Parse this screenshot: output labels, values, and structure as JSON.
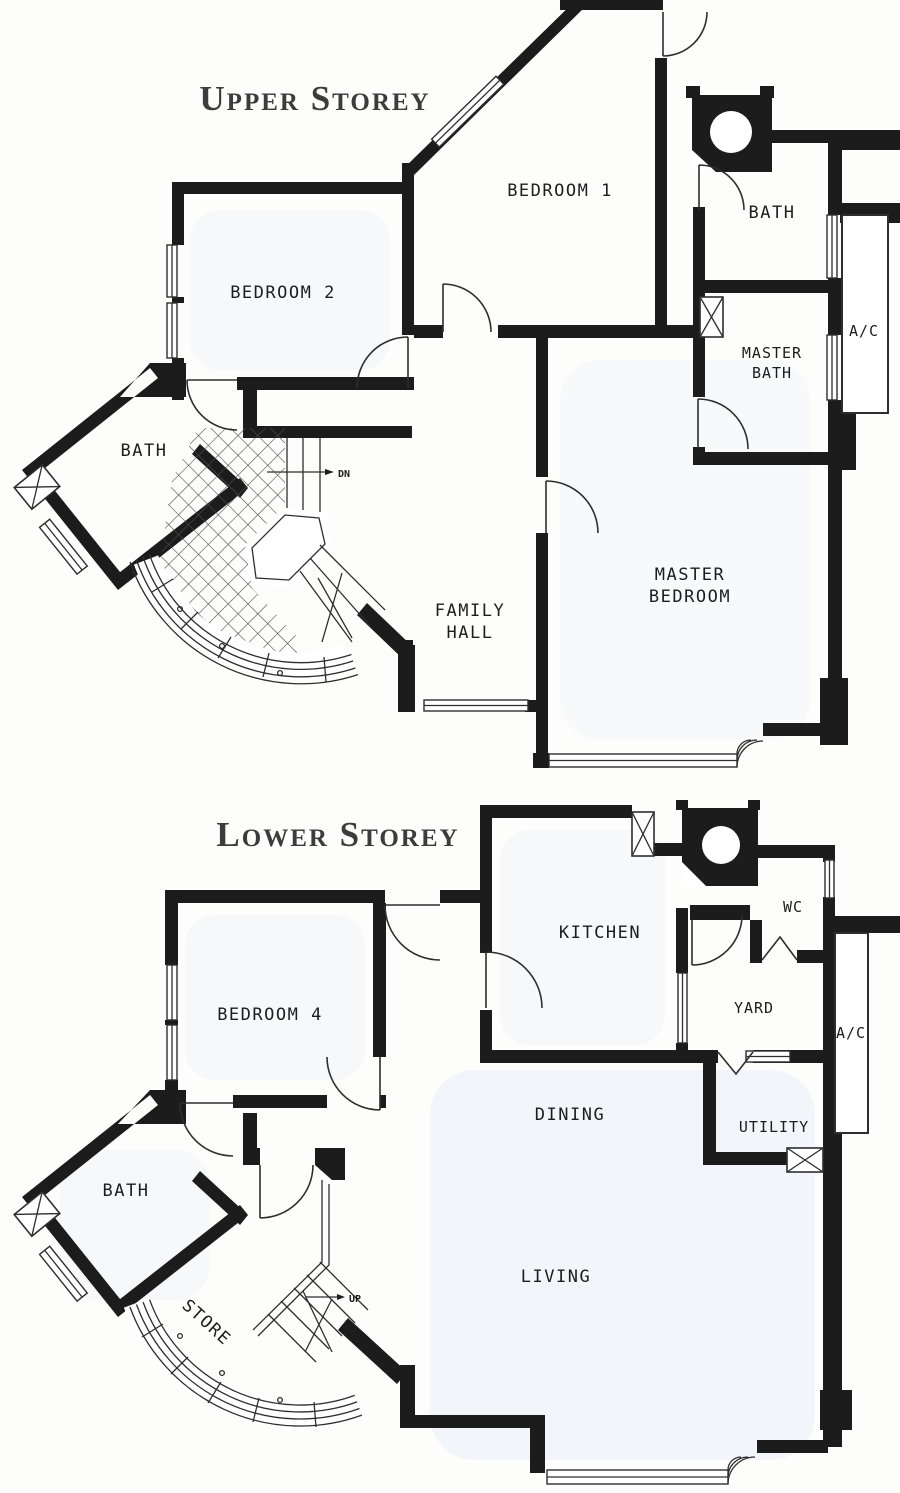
{
  "colors": {
    "wall": "#1c1c1c",
    "line": "#2e2e2e",
    "label": "#1d1d1d",
    "title": "#3c3c3c",
    "floor_tint": "#e8eef5",
    "paper": "#fdfdfc"
  },
  "upper": {
    "title": "Upper Storey",
    "labels": {
      "bedroom1": "BEDROOM 1",
      "bedroom2": "BEDROOM 2",
      "bath_right": "BATH",
      "bath_left": "BATH",
      "master_bath": [
        "MASTER",
        "BATH"
      ],
      "master_bedroom": [
        "MASTER",
        "BEDROOM"
      ],
      "family_hall": [
        "FAMILY",
        "HALL"
      ],
      "ac": "A/C",
      "stair": "DN"
    }
  },
  "lower": {
    "title": "Lower Storey",
    "labels": {
      "bedroom4": "BEDROOM 4",
      "kitchen": "KITCHEN",
      "wc": "WC",
      "yard": "YARD",
      "utility": "UTILITY",
      "dining": "DINING",
      "living": "LIVING",
      "bath": "BATH",
      "store": "STORE",
      "ac": "A/C",
      "stair": "UP"
    }
  },
  "symbols": {
    "planter_column": "column-with-circle",
    "duct_shaft": "crossed-box",
    "window": "triple-line-band",
    "door": "quarter-arc"
  }
}
